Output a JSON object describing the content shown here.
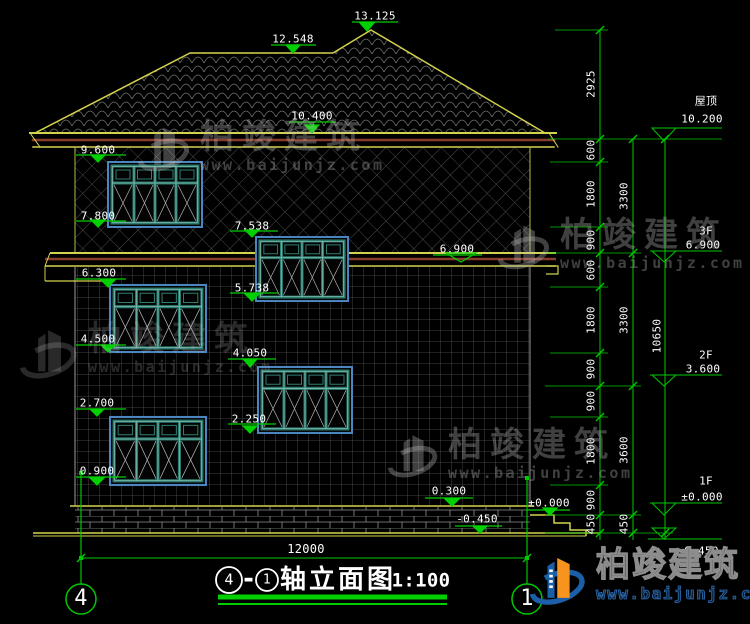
{
  "drawing": {
    "title": {
      "axis_start": "4",
      "separator": "-",
      "axis_end": "1",
      "name": "轴立面图",
      "scale": "1:100"
    },
    "axes": {
      "left": "4",
      "right": "1"
    },
    "overall_width": "12000",
    "elevation_marks": {
      "ridge_main": "13.125",
      "ridge_left": "12.548",
      "eave": "10.400",
      "w3f_head": "9.600",
      "w3f_sill": "7.800",
      "stair_head": "7.538",
      "stair_sill": "5.738",
      "band": "6.900",
      "w2f_head": "6.300",
      "w2f_sill": "4.500",
      "w2fr_head": "4.050",
      "w2fr_sill": "2.250",
      "w1f_head": "2.700",
      "w1f_sill": "0.900",
      "plinth": "0.300",
      "ground_zero": "±0.000",
      "ground": "-0.450"
    },
    "levels": {
      "roof_label": "屋顶",
      "roof": "10.200",
      "f3_label": "3F",
      "f3": "6.900",
      "f2_label": "2F",
      "f2": "3.600",
      "f1_label": "1F",
      "f1": "±0.000",
      "base": "-0.450"
    },
    "dims": {
      "chain_inner": [
        "2925",
        "600",
        "1800",
        "900",
        "600",
        "1800",
        "900",
        "900",
        "1800",
        "900",
        "450"
      ],
      "chain_floor": [
        "3300",
        "3300",
        "3600",
        "450"
      ],
      "chain_total": "10650"
    }
  },
  "watermark": {
    "name": "柏竣建筑",
    "url": "www.baijunjz.com"
  }
}
